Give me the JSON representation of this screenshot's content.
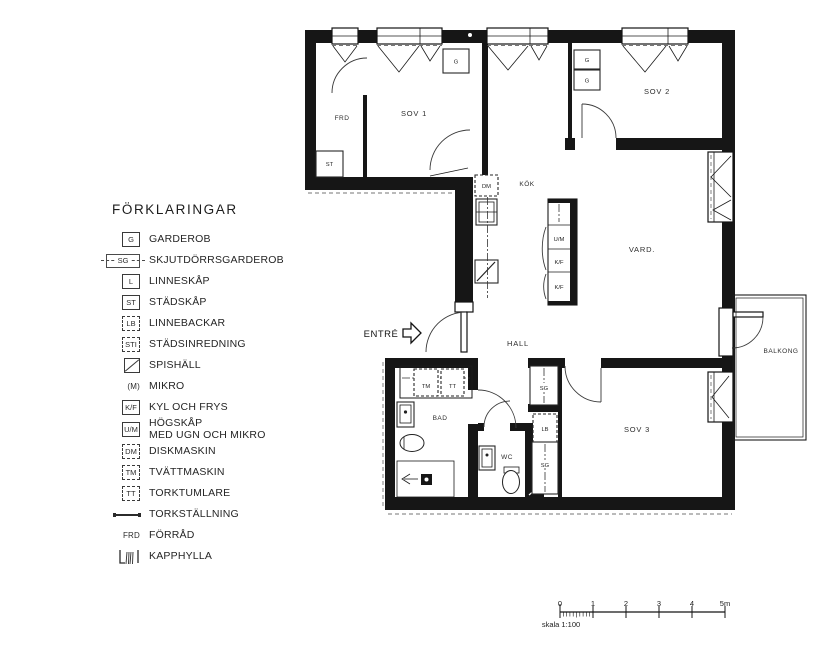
{
  "legend": {
    "title": "FÖRKLARINGAR",
    "items": [
      {
        "key": "G",
        "label": "GARDEROB"
      },
      {
        "key": "SG",
        "label": "SKJUTDÖRRSGARDEROB"
      },
      {
        "key": "L",
        "label": "LINNESKÅP"
      },
      {
        "key": "ST",
        "label": "STÄDSKÅP"
      },
      {
        "key": "LB",
        "label": "LINNEBACKAR"
      },
      {
        "key": "STI",
        "label": "STÄDSINREDNING"
      },
      {
        "key": "",
        "label": "SPISHÄLL"
      },
      {
        "key": "(M)",
        "label": "MIKRO"
      },
      {
        "key": "K/F",
        "label": "KYL OCH FRYS"
      },
      {
        "key": "U/M",
        "label": "HÖGSKÅP",
        "label2": "MED UGN OCH MIKRO"
      },
      {
        "key": "DM",
        "label": "DISKMASKIN"
      },
      {
        "key": "TM",
        "label": "TVÄTTMASKIN"
      },
      {
        "key": "TT",
        "label": "TORKTUMLARE"
      },
      {
        "key": "",
        "label": "TORKSTÄLLNING"
      },
      {
        "key": "FRD",
        "label": "FÖRRÅD"
      },
      {
        "key": "",
        "label": "KAPPHYLLA"
      }
    ]
  },
  "plan": {
    "entry_label": "ENTRÉ",
    "rooms": {
      "frd": "FRD",
      "sov1": "SOV 1",
      "kok": "KÖK",
      "sov2": "SOV 2",
      "vard": "VARD.",
      "hall": "HALL",
      "bad": "BAD",
      "wc": "WC",
      "sov3": "SOV 3",
      "balkong": "BALKONG"
    },
    "fixtures": {
      "g": "G",
      "st": "ST",
      "sg": "SG",
      "lb": "LB",
      "dm": "DM",
      "tm": "TM",
      "tt": "TT",
      "um": "U/M",
      "kf": "K/F"
    }
  },
  "scalebar": {
    "ticks": [
      "0",
      "1",
      "2",
      "3",
      "4",
      "5m"
    ],
    "caption": "skala 1:100"
  }
}
